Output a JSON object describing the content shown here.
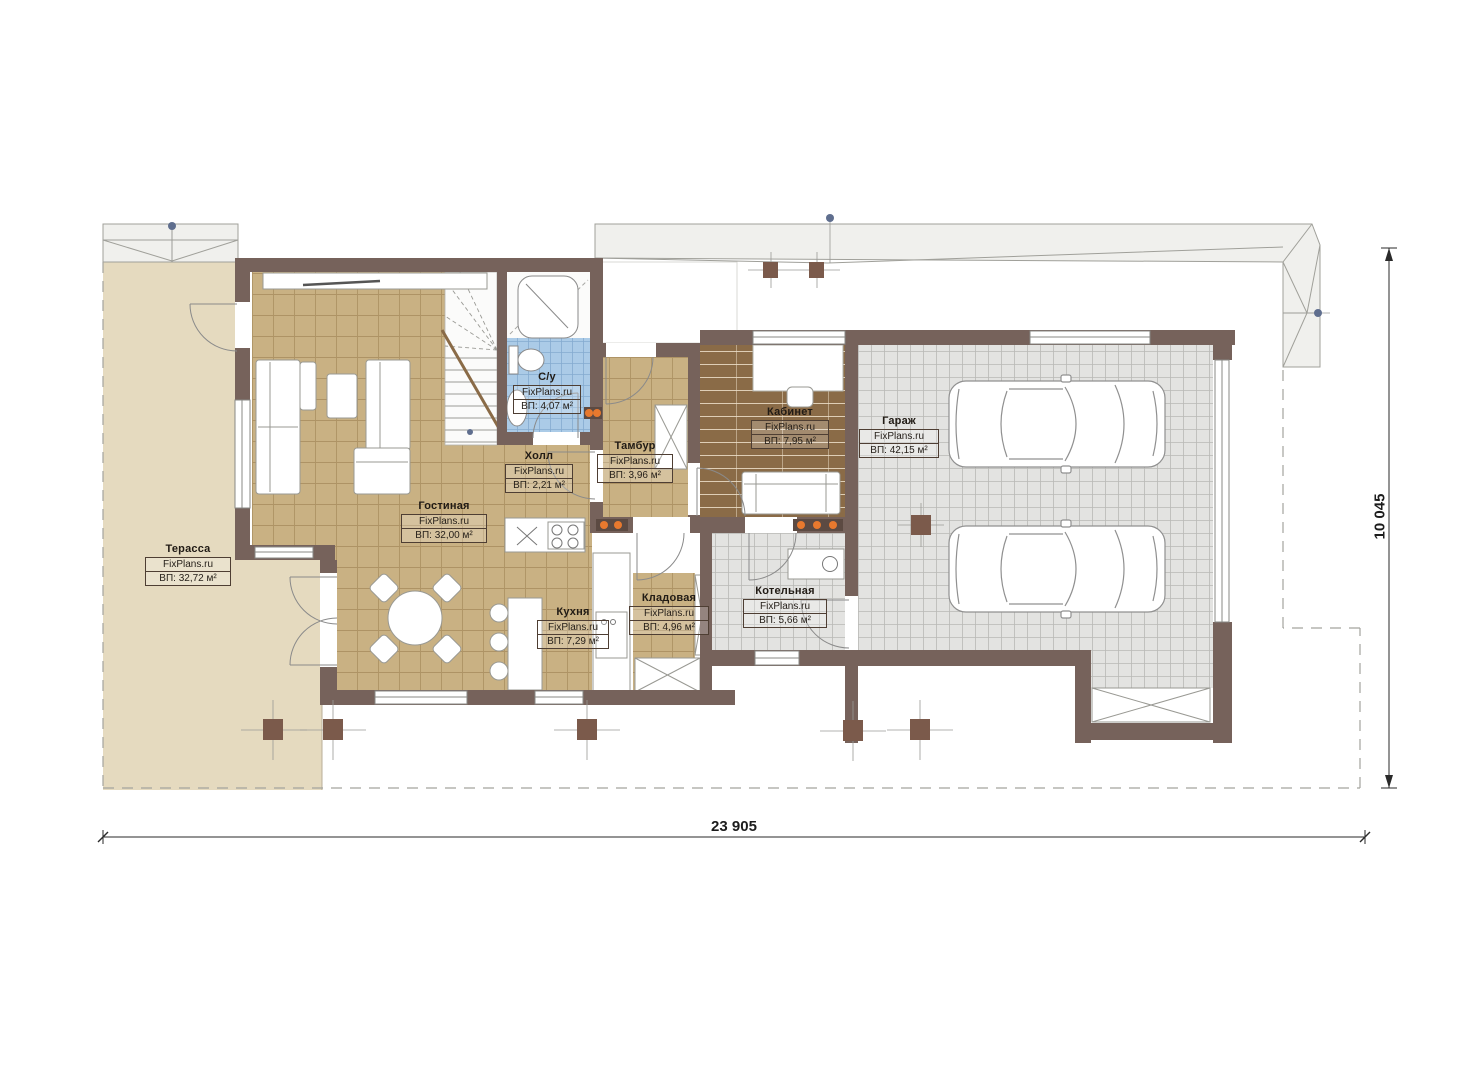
{
  "brand": "FixPlans.ru",
  "rooms": [
    {
      "name": "Терасса",
      "area": "ВП: 32,72 м²"
    },
    {
      "name": "Гостиная",
      "area": "ВП: 32,00 м²"
    },
    {
      "name": "С/у",
      "area": "ВП: 4,07 м²"
    },
    {
      "name": "Холл",
      "area": "ВП: 2,21 м²"
    },
    {
      "name": "Тамбур",
      "area": "ВП: 3,96 м²"
    },
    {
      "name": "Кабинет",
      "area": "ВП: 7,95 м²"
    },
    {
      "name": "Гараж",
      "area": "ВП: 42,15 м²"
    },
    {
      "name": "Кухня",
      "area": "ВП: 7,29 м²"
    },
    {
      "name": "Кладовая",
      "area": "ВП: 4,96 м²"
    },
    {
      "name": "Котельная",
      "area": "ВП: 5,66 м²"
    }
  ],
  "dimensions": {
    "width_label": "23 905",
    "height_label": "10 045"
  },
  "colors": {
    "wall": "#76625b",
    "column": "#7b5a4b",
    "floor_tile_tan": "#c9b183",
    "terrace": "#e5dabf",
    "garage_floor": "#e3e3e1",
    "bath_floor": "#abcbe7",
    "study_floor": "#8a6b47",
    "roof": "#f0f0ed",
    "radiator_orange": "#e8792e",
    "marker_blue": "#5f6e8e"
  }
}
